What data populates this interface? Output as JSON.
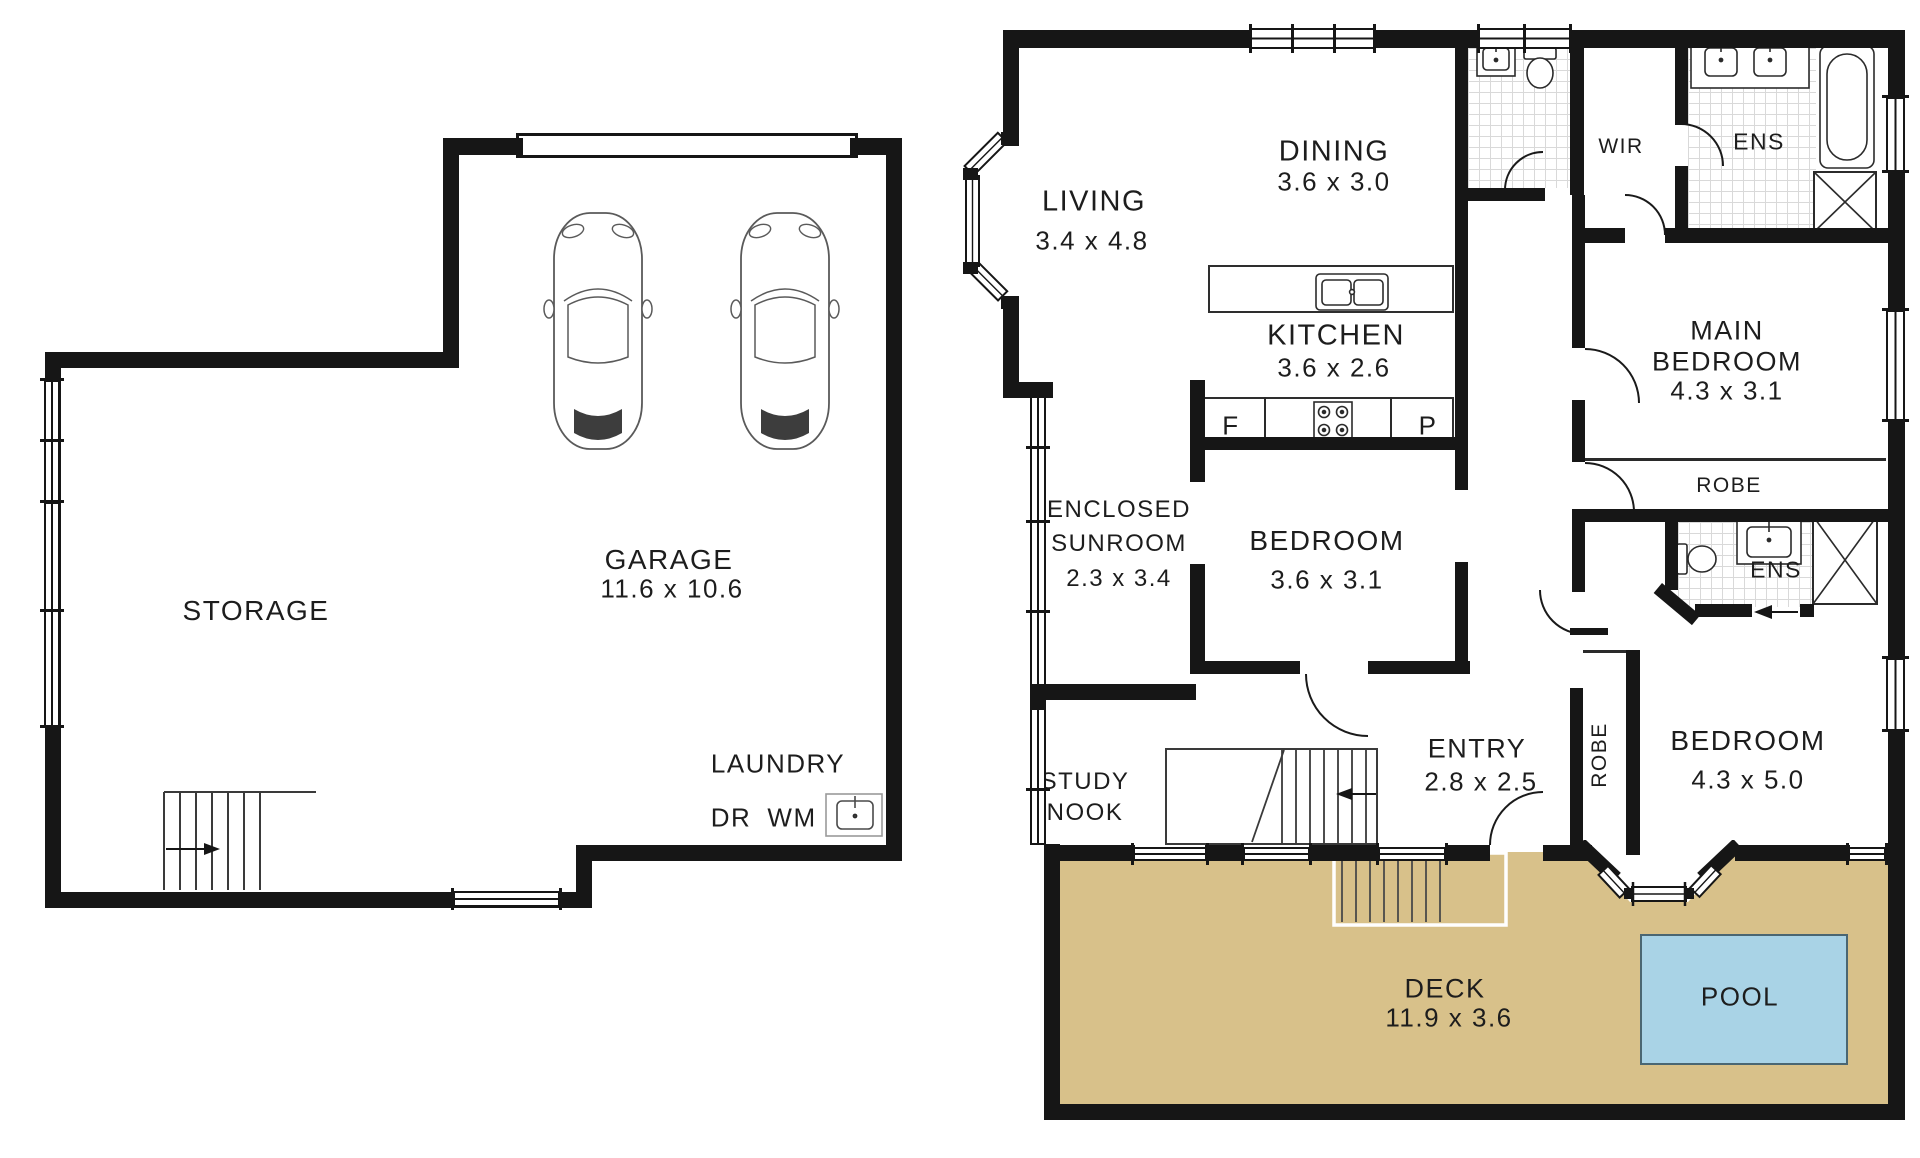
{
  "colors": {
    "deck": "#D8C18A",
    "pool": "#A9D3E6",
    "wall": "#161616",
    "text": "#1d1d1d"
  },
  "labels": {
    "storage": "STORAGE",
    "garage": "GARAGE",
    "garage_dims": "11.6 x 10.6",
    "laundry": "LAUNDRY",
    "dr": "DR",
    "wm": "WM",
    "living": "LIVING",
    "living_dims": "3.4 x 4.8",
    "dining": "DINING",
    "dining_dims": "3.6 x 3.0",
    "kitchen": "KITCHEN",
    "kitchen_dims": "3.6 x 2.6",
    "fridge": "F",
    "pantry": "P",
    "sunroom_1": "ENCLOSED",
    "sunroom_2": "SUNROOM",
    "sunroom_dims": "2.3 x 3.4",
    "bedroom1": "BEDROOM",
    "bedroom1_dims": "3.6 x 3.1",
    "study_1": "STUDY",
    "study_2": "NOOK",
    "entry": "ENTRY",
    "entry_dims": "2.8 x 2.5",
    "robe_entry": "ROBE",
    "bedroom2": "BEDROOM",
    "bedroom2_dims": "4.3 x 5.0",
    "main_1": "MAIN",
    "main_2": "BEDROOM",
    "main_dims": "4.3 x 3.1",
    "robe_main": "ROBE",
    "wir": "WIR",
    "ens1": "ENS",
    "ens2": "ENS",
    "deck": "DECK",
    "deck_dims": "11.9 x 3.6",
    "pool": "POOL"
  }
}
